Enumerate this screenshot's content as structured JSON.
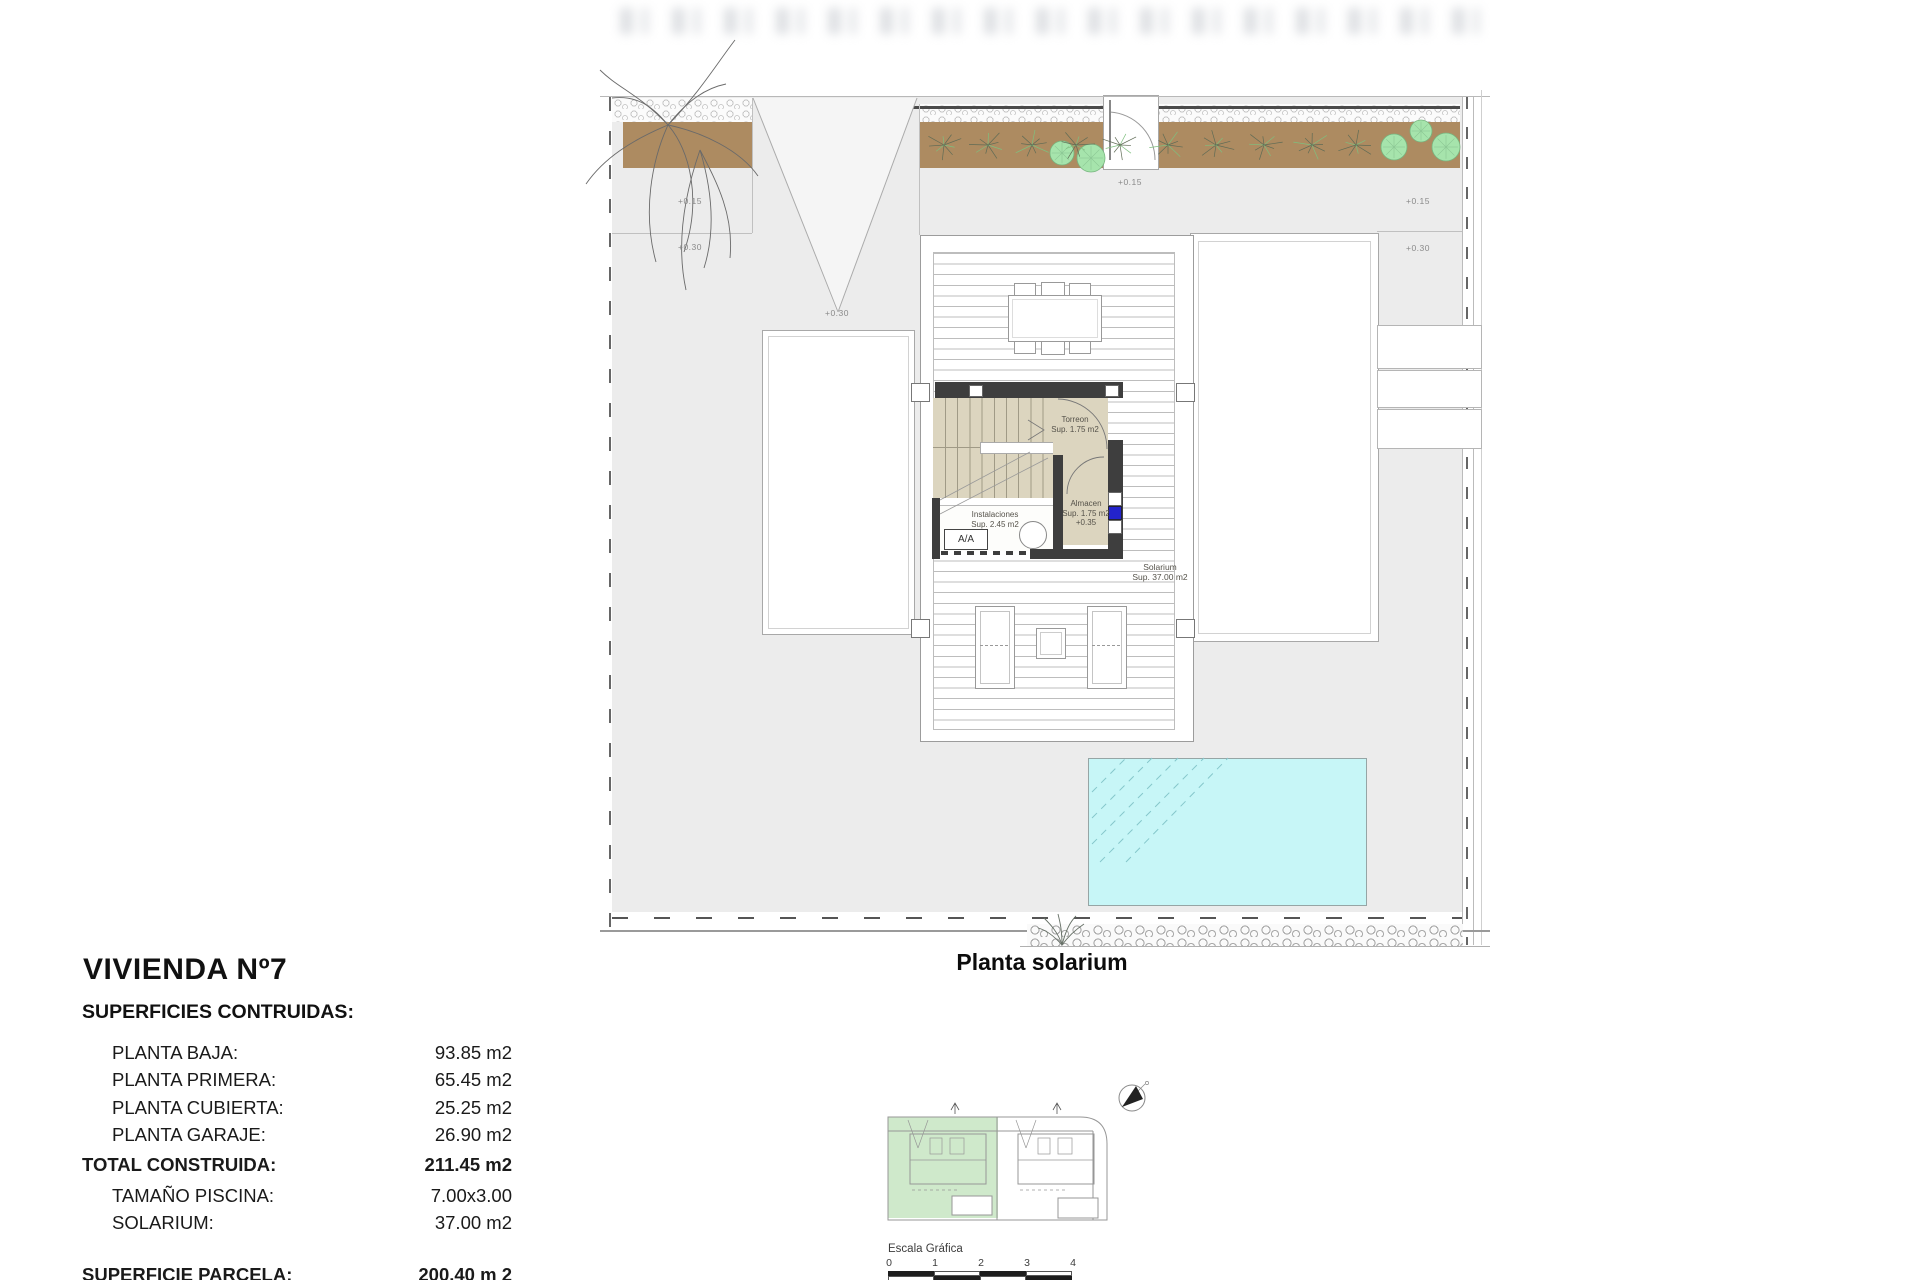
{
  "sheet": {
    "plan_caption": "Planta solarium",
    "title_block": {
      "title": "VIVIENDA Nº7",
      "subtitle": "SUPERFICIES CONTRUIDAS:",
      "rows": [
        {
          "label": "PLANTA BAJA:",
          "value": "93.85 m2"
        },
        {
          "label": "PLANTA PRIMERA:",
          "value": "65.45 m2"
        },
        {
          "label": "PLANTA CUBIERTA:",
          "value": "25.25 m2"
        },
        {
          "label": "PLANTA GARAJE:",
          "value": "26.90 m2"
        },
        {
          "label": "TOTAL CONSTRUIDA:",
          "value": "211.45 m2"
        },
        {
          "label": "TAMAÑO PISCINA:",
          "value": "7.00x3.00"
        },
        {
          "label": "SOLARIUM:",
          "value": "37.00 m2"
        },
        {
          "label": "SUPERFICIE PARCELA:",
          "value": "200.40 m 2"
        }
      ]
    },
    "plan": {
      "rooms": {
        "torreon": {
          "name": "Torreon",
          "area": "Sup. 1.75 m2"
        },
        "almacen": {
          "name": "Almacen",
          "area": "Sup. 1.75 m2",
          "level": "+0.35"
        },
        "instalaciones": {
          "name": "Instalaciones",
          "area": "Sup. 2.45 m2"
        },
        "solarium": {
          "name": "Solarium",
          "area": "Sup. 37.00 m2"
        },
        "aa_unit": {
          "label": "A/A"
        }
      },
      "levels": [
        {
          "text": "+0.15"
        },
        {
          "text": "+0.30"
        },
        {
          "text": "+0.30"
        },
        {
          "text": "+0.15"
        },
        {
          "text": "+0.15"
        },
        {
          "text": "+0.30"
        }
      ],
      "colors": {
        "pool": "#c7f6f7",
        "wall": "#3e3e3e",
        "stair_floor": "#dcd5bf",
        "planting_bed": "#ad8b61",
        "tree": "#a6e4ac",
        "key_map_highlight": "#cfe9cb",
        "accent_blue": "#2323cb"
      }
    },
    "scale_bar": {
      "label": "Escala Gráfica",
      "ticks": [
        "0",
        "1",
        "2",
        "3",
        "4"
      ]
    }
  }
}
